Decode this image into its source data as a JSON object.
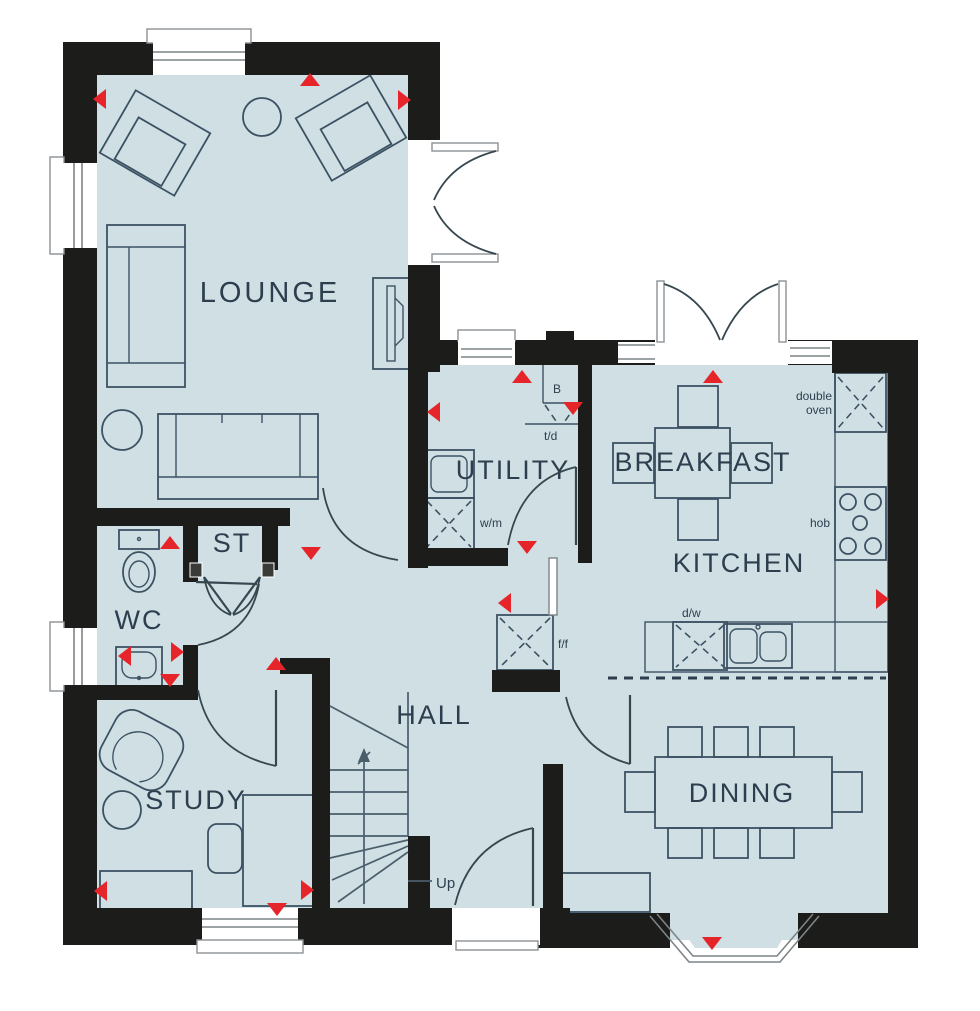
{
  "palette": {
    "floor": "#cfdfe4",
    "wall": "#1c1c1a",
    "furniture_line": "#3c5263",
    "marker_red": "#e6252b",
    "label_text": "#2d3f4f",
    "window_frame": "#8d9194"
  },
  "rooms": [
    {
      "id": "lounge",
      "label": "LOUNGE"
    },
    {
      "id": "utility",
      "label": "UTILITY"
    },
    {
      "id": "breakfast",
      "label": "BREAKFAST"
    },
    {
      "id": "kitchen",
      "label": "KITCHEN"
    },
    {
      "id": "storage",
      "label": "ST"
    },
    {
      "id": "wc",
      "label": "WC"
    },
    {
      "id": "hall",
      "label": "HALL"
    },
    {
      "id": "study",
      "label": "STUDY"
    },
    {
      "id": "dining",
      "label": "DINING"
    }
  ],
  "annotations": {
    "stairs_up": "Up",
    "boiler": "B",
    "tumble_dryer": "t/d",
    "washing_machine": "w/m",
    "fridge_freezer": "f/f",
    "dishwasher": "d/w",
    "hob": "hob",
    "double_oven": [
      "double",
      "oven"
    ]
  }
}
